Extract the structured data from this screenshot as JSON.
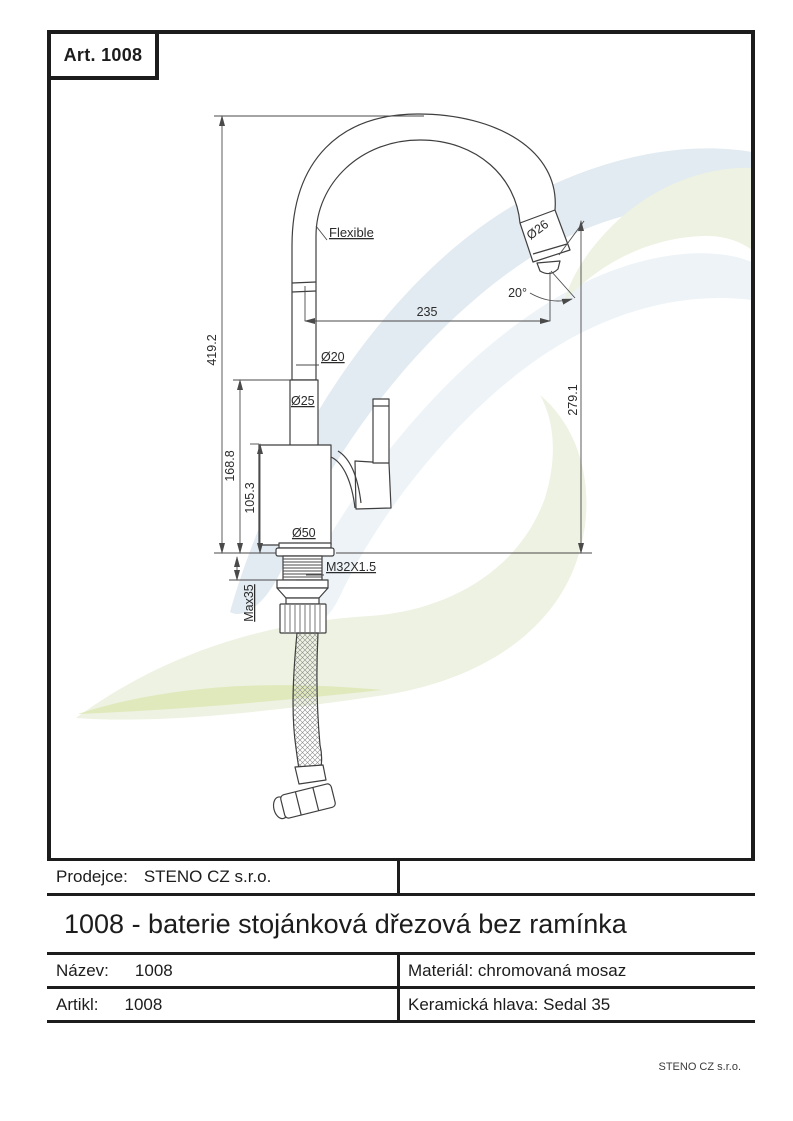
{
  "page": {
    "art_label": "Art. 1008",
    "footer_company": "STENO CZ s.r.o."
  },
  "drawing": {
    "labels": {
      "flexible": "Flexible",
      "dia26": "Ø26",
      "angle20": "20°",
      "dim_235": "235",
      "dim_419_2": "419.2",
      "dia20": "Ø20",
      "dia25": "Ø25",
      "dim_279_1": "279.1",
      "dim_168_8": "168.8",
      "dim_105_3": "105.3",
      "dia50": "Ø50",
      "thread": "M32X1.5",
      "max35": "Max35"
    }
  },
  "title_block": {
    "prodejce_label": "Prodejce:",
    "prodejce_value": "STENO CZ s.r.o.",
    "product_title": "1008 - baterie stojánková dřezová bez ramínka",
    "nazev_label": "Název:",
    "nazev_value": "1008",
    "material_text": "Materiál: chromovaná mosaz",
    "artikl_label": "Artikl:",
    "artikl_value": "1008",
    "ceramic_text": "Keramická hlava: Sedal 35"
  },
  "colors": {
    "border": "#1c1c1c",
    "line": "#3f3f3f",
    "dim_line": "#4a4a4a",
    "watermark_blue": "#e2ebf1",
    "watermark_blue_light": "#edf3f7",
    "watermark_green": "#edf2e2",
    "watermark_green_bright": "#dfe9bb"
  }
}
